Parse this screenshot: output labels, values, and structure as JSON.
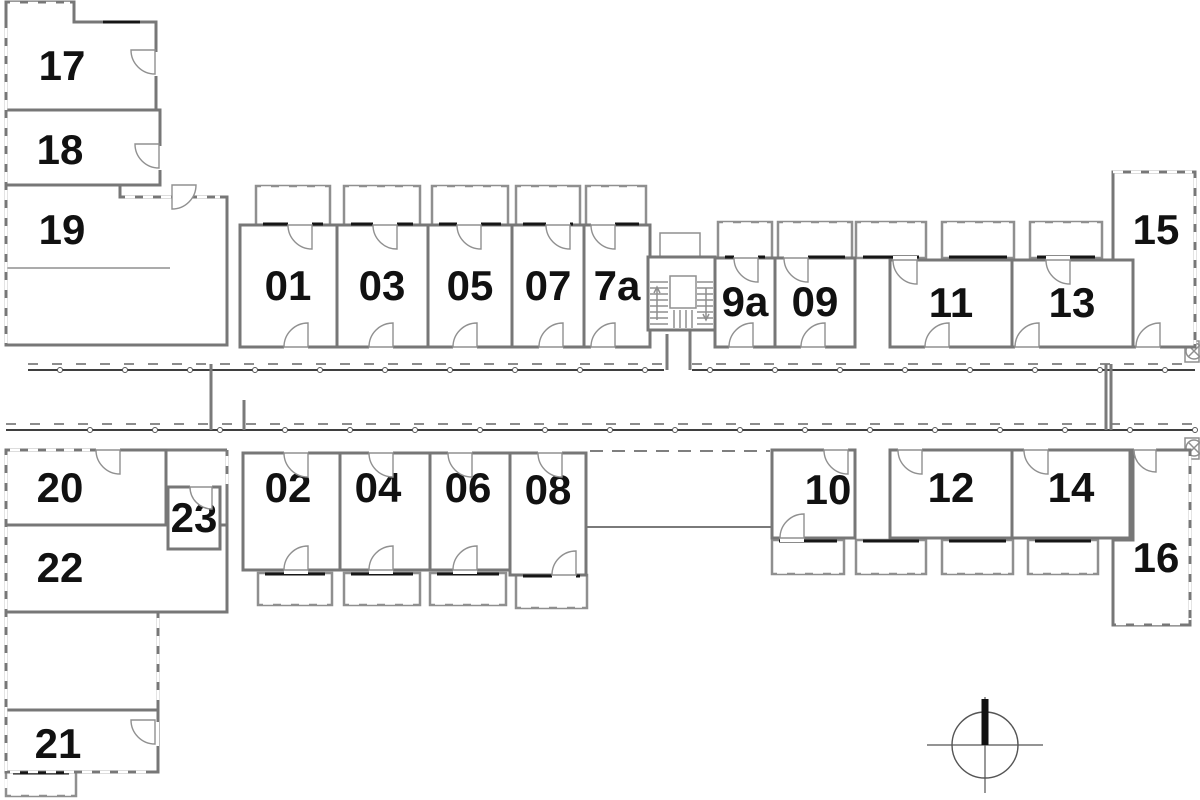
{
  "page": {
    "background": "#ffffff"
  },
  "colors": {
    "highlight": "#E8A43C",
    "wall": "#777777",
    "wall_light": "#8F8F8F",
    "accent": "#161616",
    "dash": "#555555",
    "label": "#111111"
  },
  "icons": {
    "north_arrow": "north-arrow-icon",
    "stairs": "stairs-icon",
    "elevator": "elevator-icon"
  },
  "highlighted_unit": "08",
  "rooms": [
    {
      "id": "17",
      "label": "17",
      "pts": "6,2 74,2 74,22 156,22 156,110 6,110",
      "lx": 62,
      "ly": 80
    },
    {
      "id": "18",
      "label": "18",
      "x": 6,
      "y": 110,
      "w": 154,
      "h": 75,
      "lx": 60,
      "ly": 164
    },
    {
      "id": "19",
      "label": "19",
      "pts": "6,185 120,185 120,197 227,197 227,345 6,345",
      "lx": 62,
      "ly": 244
    },
    {
      "id": "01",
      "label": "01",
      "x": 240,
      "y": 225,
      "w": 97,
      "h": 122,
      "lx": 288,
      "ly": 300
    },
    {
      "id": "03",
      "label": "03",
      "x": 337,
      "y": 225,
      "w": 91,
      "h": 122,
      "lx": 382,
      "ly": 300
    },
    {
      "id": "05",
      "label": "05",
      "x": 428,
      "y": 225,
      "w": 84,
      "h": 122,
      "lx": 470,
      "ly": 300
    },
    {
      "id": "07",
      "label": "07",
      "x": 512,
      "y": 225,
      "w": 72,
      "h": 122,
      "lx": 548,
      "ly": 300
    },
    {
      "id": "7a",
      "label": "7a",
      "x": 584,
      "y": 225,
      "w": 66,
      "h": 122,
      "lx": 617,
      "ly": 300
    },
    {
      "id": "9a",
      "label": "9a",
      "x": 715,
      "y": 258,
      "w": 60,
      "h": 89,
      "lx": 745,
      "ly": 316
    },
    {
      "id": "09",
      "label": "09",
      "x": 775,
      "y": 258,
      "w": 80,
      "h": 89,
      "lx": 815,
      "ly": 316
    },
    {
      "id": "11",
      "label": "11",
      "x": 890,
      "y": 260,
      "w": 122,
      "h": 87,
      "lx": 951,
      "ly": 317
    },
    {
      "id": "13",
      "label": "13",
      "x": 1012,
      "y": 260,
      "w": 121,
      "h": 87,
      "lx": 1072,
      "ly": 317
    },
    {
      "id": "15",
      "label": "15",
      "pts": "1113,172 1195,172 1195,347 1133,347 1133,260 1113,260",
      "lx": 1156,
      "ly": 244
    },
    {
      "id": "20",
      "label": "20",
      "x": 6,
      "y": 450,
      "w": 160,
      "h": 75,
      "lx": 60,
      "ly": 502
    },
    {
      "id": "22",
      "label": "22",
      "x": 6,
      "y": 525,
      "w": 221,
      "h": 87,
      "lx": 60,
      "ly": 582
    },
    {
      "id": "hall",
      "label": "",
      "x": 6,
      "y": 612,
      "w": 152,
      "h": 98
    },
    {
      "id": "21",
      "label": "21",
      "x": 6,
      "y": 710,
      "w": 152,
      "h": 62,
      "lx": 58,
      "ly": 758
    },
    {
      "id": "23",
      "label": "23",
      "x": 168,
      "y": 487,
      "w": 52,
      "h": 62,
      "lx": 194,
      "ly": 532
    },
    {
      "id": "02",
      "label": "02",
      "x": 243,
      "y": 453,
      "w": 97,
      "h": 117,
      "lx": 288,
      "ly": 502
    },
    {
      "id": "04",
      "label": "04",
      "x": 340,
      "y": 453,
      "w": 90,
      "h": 117,
      "lx": 378,
      "ly": 502
    },
    {
      "id": "06",
      "label": "06",
      "x": 430,
      "y": 453,
      "w": 80,
      "h": 117,
      "lx": 468,
      "ly": 502
    },
    {
      "id": "08",
      "label": "08",
      "x": 510,
      "y": 453,
      "w": 76,
      "h": 122,
      "hl": true,
      "lx": 548,
      "ly": 504
    },
    {
      "id": "10",
      "label": "10",
      "x": 772,
      "y": 450,
      "w": 83,
      "h": 88,
      "lx": 828,
      "ly": 504
    },
    {
      "id": "12",
      "label": "12",
      "x": 890,
      "y": 450,
      "w": 122,
      "h": 88,
      "lx": 951,
      "ly": 502
    },
    {
      "id": "14",
      "label": "14",
      "x": 1012,
      "y": 450,
      "w": 118,
      "h": 88,
      "lx": 1071,
      "ly": 502
    },
    {
      "id": "16",
      "label": "16",
      "pts": "1133,450 1190,450 1190,625 1113,625 1113,540 1133,540",
      "lx": 1156,
      "ly": 572
    }
  ],
  "balconies": [
    {
      "id": "01",
      "x": 256,
      "y": 186,
      "w": 74,
      "h": 39,
      "edge": "top"
    },
    {
      "id": "03",
      "x": 344,
      "y": 186,
      "w": 76,
      "h": 39,
      "edge": "top"
    },
    {
      "id": "05",
      "x": 432,
      "y": 186,
      "w": 76,
      "h": 39,
      "edge": "top"
    },
    {
      "id": "07",
      "x": 516,
      "y": 186,
      "w": 64,
      "h": 39,
      "edge": "top"
    },
    {
      "id": "7a",
      "x": 586,
      "y": 186,
      "w": 60,
      "h": 39,
      "edge": "top"
    },
    {
      "id": "9a",
      "x": 718,
      "y": 222,
      "w": 54,
      "h": 36,
      "edge": "top"
    },
    {
      "id": "09",
      "x": 778,
      "y": 222,
      "w": 74,
      "h": 36,
      "edge": "top"
    },
    {
      "id": "gap-n",
      "x": 856,
      "y": 222,
      "w": 70,
      "h": 36,
      "edge": "top"
    },
    {
      "id": "11",
      "x": 942,
      "y": 222,
      "w": 72,
      "h": 36,
      "edge": "top"
    },
    {
      "id": "13",
      "x": 1030,
      "y": 222,
      "w": 72,
      "h": 36,
      "edge": "top"
    },
    {
      "id": "02",
      "x": 258,
      "y": 573,
      "w": 74,
      "h": 32,
      "edge": "bottom"
    },
    {
      "id": "04",
      "x": 344,
      "y": 573,
      "w": 76,
      "h": 32,
      "edge": "bottom"
    },
    {
      "id": "06",
      "x": 430,
      "y": 573,
      "w": 76,
      "h": 32,
      "edge": "bottom"
    },
    {
      "id": "08",
      "x": 516,
      "y": 575,
      "w": 71,
      "h": 33,
      "edge": "bottom",
      "hl": true
    },
    {
      "id": "10",
      "x": 772,
      "y": 540,
      "w": 72,
      "h": 34,
      "edge": "bottom"
    },
    {
      "id": "gap-s",
      "x": 856,
      "y": 540,
      "w": 70,
      "h": 34,
      "edge": "bottom"
    },
    {
      "id": "12",
      "x": 942,
      "y": 540,
      "w": 71,
      "h": 34,
      "edge": "bottom"
    },
    {
      "id": "14",
      "x": 1028,
      "y": 540,
      "w": 70,
      "h": 34,
      "edge": "bottom"
    },
    {
      "id": "21",
      "x": 6,
      "y": 772,
      "w": 70,
      "h": 24,
      "edge": "bottom"
    }
  ],
  "doors": [
    {
      "gap": [
        288,
        221,
        24,
        8
      ],
      "h": [
        312,
        225
      ],
      "q": "sw"
    },
    {
      "gap": [
        373,
        221,
        24,
        8
      ],
      "h": [
        397,
        225
      ],
      "q": "sw"
    },
    {
      "gap": [
        457,
        221,
        24,
        8
      ],
      "h": [
        481,
        225
      ],
      "q": "sw"
    },
    {
      "gap": [
        546,
        221,
        24,
        8
      ],
      "h": [
        570,
        225
      ],
      "q": "sw"
    },
    {
      "gap": [
        591,
        221,
        24,
        8
      ],
      "h": [
        615,
        225
      ],
      "q": "sw"
    },
    {
      "gap": [
        734,
        254,
        24,
        8
      ],
      "h": [
        758,
        258
      ],
      "q": "sw"
    },
    {
      "gap": [
        784,
        254,
        24,
        8
      ],
      "h": [
        808,
        258
      ],
      "q": "sw"
    },
    {
      "gap": [
        893,
        256,
        24,
        8
      ],
      "h": [
        917,
        260
      ],
      "q": "sw"
    },
    {
      "gap": [
        1046,
        256,
        24,
        8
      ],
      "h": [
        1070,
        260
      ],
      "q": "sw"
    },
    {
      "gap": [
        284,
        343,
        24,
        8
      ],
      "h": [
        308,
        347
      ],
      "q": "nw"
    },
    {
      "gap": [
        369,
        343,
        24,
        8
      ],
      "h": [
        393,
        347
      ],
      "q": "nw"
    },
    {
      "gap": [
        453,
        343,
        24,
        8
      ],
      "h": [
        477,
        347
      ],
      "q": "nw"
    },
    {
      "gap": [
        539,
        343,
        24,
        8
      ],
      "h": [
        563,
        347
      ],
      "q": "nw"
    },
    {
      "gap": [
        591,
        343,
        24,
        8
      ],
      "h": [
        615,
        347
      ],
      "q": "nw"
    },
    {
      "gap": [
        729,
        343,
        24,
        8
      ],
      "h": [
        753,
        347
      ],
      "q": "nw"
    },
    {
      "gap": [
        801,
        343,
        24,
        8
      ],
      "h": [
        825,
        347
      ],
      "q": "nw"
    },
    {
      "gap": [
        925,
        343,
        24,
        8
      ],
      "h": [
        949,
        347
      ],
      "q": "nw"
    },
    {
      "gap": [
        1015,
        343,
        24,
        8
      ],
      "h": [
        1039,
        347
      ],
      "q": "nw"
    },
    {
      "gap": [
        1136,
        343,
        24,
        8
      ],
      "h": [
        1160,
        347
      ],
      "q": "nw"
    },
    {
      "gap": [
        284,
        449,
        24,
        8
      ],
      "h": [
        308,
        453
      ],
      "q": "sw"
    },
    {
      "gap": [
        369,
        449,
        24,
        8
      ],
      "h": [
        393,
        453
      ],
      "q": "sw"
    },
    {
      "gap": [
        448,
        449,
        24,
        8
      ],
      "h": [
        472,
        453
      ],
      "q": "sw"
    },
    {
      "gap": [
        538,
        449,
        24,
        10
      ],
      "h": [
        562,
        453
      ],
      "q": "sw"
    },
    {
      "gap": [
        824,
        446,
        24,
        8
      ],
      "h": [
        848,
        450
      ],
      "q": "sw"
    },
    {
      "gap": [
        898,
        446,
        24,
        8
      ],
      "h": [
        922,
        450
      ],
      "q": "sw"
    },
    {
      "gap": [
        1024,
        446,
        24,
        8
      ],
      "h": [
        1048,
        450
      ],
      "q": "sw"
    },
    {
      "gap": [
        1134,
        446,
        22,
        8
      ],
      "h": [
        1156,
        450
      ],
      "q": "sw",
      "r": 22
    },
    {
      "gap": [
        284,
        566,
        24,
        8
      ],
      "h": [
        308,
        570
      ],
      "q": "nw"
    },
    {
      "gap": [
        369,
        566,
        24,
        8
      ],
      "h": [
        393,
        570
      ],
      "q": "nw"
    },
    {
      "gap": [
        453,
        566,
        24,
        8
      ],
      "h": [
        477,
        570
      ],
      "q": "nw"
    },
    {
      "gap": [
        552,
        571,
        24,
        8
      ],
      "h": [
        576,
        575
      ],
      "q": "nw"
    },
    {
      "gap": [
        780,
        534,
        24,
        8
      ],
      "h": [
        804,
        538
      ],
      "q": "nw"
    },
    {
      "gap": [
        151,
        52,
        8,
        24
      ],
      "h": [
        155,
        50
      ],
      "q": "sw"
    },
    {
      "gap": [
        155,
        146,
        8,
        24
      ],
      "h": [
        159,
        144
      ],
      "q": "sw"
    },
    {
      "gap": [
        172,
        181,
        24,
        8
      ],
      "h": [
        172,
        185
      ],
      "q": "se"
    },
    {
      "gap": [
        190,
        483,
        22,
        8
      ],
      "h": [
        212,
        487
      ],
      "q": "sw",
      "r": 22
    },
    {
      "gap": [
        151,
        722,
        8,
        24
      ],
      "h": [
        155,
        720
      ],
      "q": "sw"
    },
    {
      "gap": [
        652,
        326,
        24,
        8
      ],
      "h": [
        652,
        330
      ],
      "q": "ne"
    },
    {
      "gap": [
        96,
        446,
        24,
        8
      ],
      "h": [
        120,
        450
      ],
      "q": "sw"
    }
  ],
  "compass": {
    "cx": 985,
    "cy": 745,
    "r": 33
  }
}
